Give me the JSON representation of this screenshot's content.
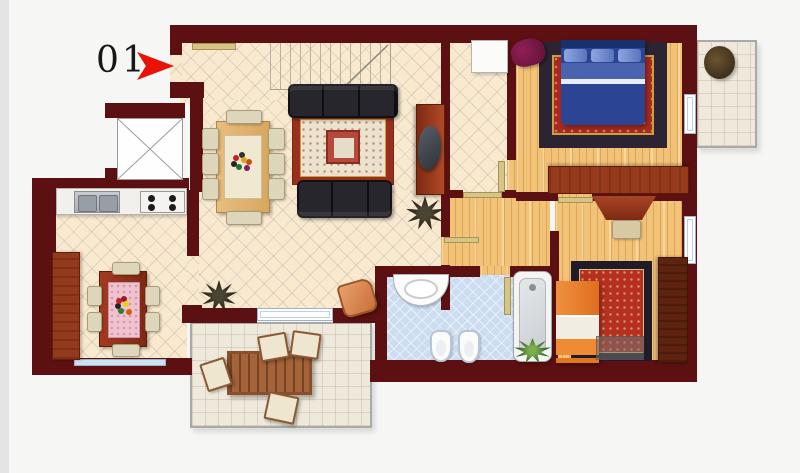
{
  "page": {
    "background": "#f6f6f5",
    "left_strip_color": "#e4e4e4"
  },
  "plan": {
    "unit_label": "01",
    "arrow_color": "#e81208",
    "colors": {
      "wall": "#5c1011",
      "tile_floor": "#f9e9cf",
      "wood_floor": "#f2c277",
      "bathroom_floor": "#ccddf1",
      "outdoor_floor": "#efe9dc",
      "door_leaf": "#d9c488",
      "living_rug_border": "#99301f",
      "bedroom_rug_red": "#a82a1e",
      "sofa": "#26262c",
      "double_bed_blue": "#2c4494",
      "single_bed_orange": "#ea7e28",
      "furniture_wood": "#a0462a",
      "armchair_purple": "#7a1545"
    },
    "rooms": [
      "living-room",
      "kitchen",
      "entrance-corridor",
      "inner-hall",
      "bedroom-main",
      "bedroom-second",
      "bathroom",
      "terrace",
      "balcony",
      "elevator-shaft",
      "staircase"
    ],
    "furniture": [
      "entrance-door",
      "staircase",
      "sectional-sofa",
      "living-rug",
      "dining-table",
      "dining-chairs",
      "tv-sideboard",
      "plants",
      "kitchen-counter",
      "kitchen-sink",
      "stove",
      "kitchen-cabinet",
      "kitchen-table",
      "double-bed",
      "bedroom-rug",
      "armchair",
      "dresser",
      "wardrobe",
      "desk",
      "desk-chair",
      "single-bed",
      "bedside-unit",
      "washbasin",
      "toilet",
      "bidet",
      "bathtub",
      "terrace-table",
      "terrace-chairs",
      "balcony-plant"
    ]
  }
}
